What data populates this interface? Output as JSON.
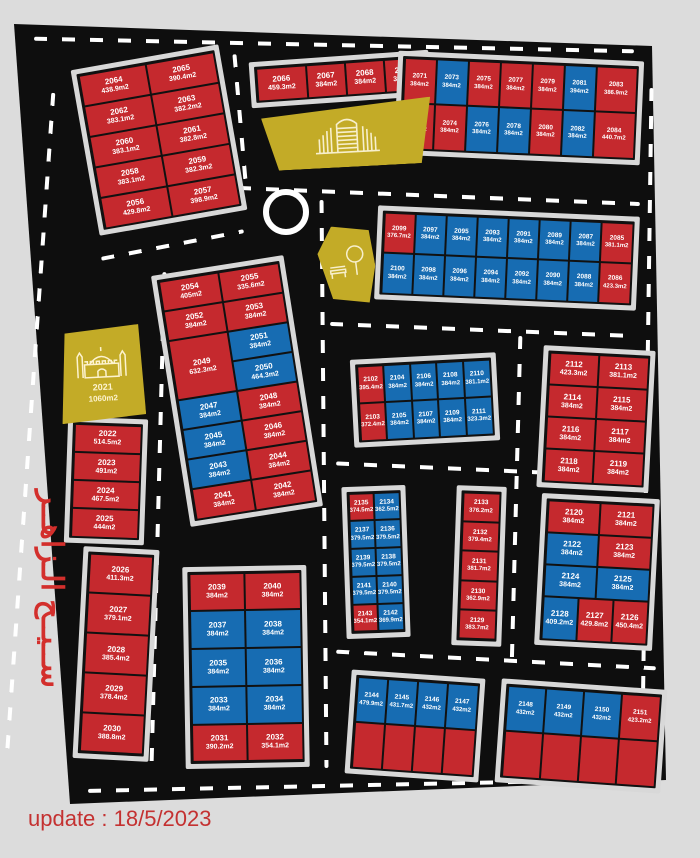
{
  "page": {
    "update_label": "update : 18/5/2023",
    "district_name": "ســيــح الـزاهــر"
  },
  "legend_colors": {
    "plot_red": "#c5292e",
    "plot_blue": "#176cb2",
    "landmark_yellow": "#c3ab27",
    "road_black": "#0e0e0e",
    "sidewalk_gray": "#d8d8d8",
    "page_bg": "#dcdcdc",
    "accent_text_red": "#d32f2c"
  },
  "landmarks": {
    "mosque": {
      "number": "2021",
      "area": "1060m2"
    }
  },
  "blocks": {
    "blockA": {
      "name": "plots 2056-2065",
      "plots": [
        {
          "n": "2064",
          "a": "438.9m2",
          "c": "r"
        },
        {
          "n": "2065",
          "a": "390.4m2",
          "c": "r"
        },
        {
          "n": "2062",
          "a": "383.1m2",
          "c": "r"
        },
        {
          "n": "2063",
          "a": "382.2m2",
          "c": "r"
        },
        {
          "n": "2060",
          "a": "383.1m2",
          "c": "r"
        },
        {
          "n": "2061",
          "a": "382.8m2",
          "c": "r"
        },
        {
          "n": "2058",
          "a": "383.1m2",
          "c": "r"
        },
        {
          "n": "2059",
          "a": "382.3m2",
          "c": "r"
        },
        {
          "n": "2056",
          "a": "429.8m2",
          "c": "r"
        },
        {
          "n": "2057",
          "a": "398.9m2",
          "c": "r"
        }
      ]
    },
    "blockB": {
      "name": "plots 2066-2069",
      "plots": [
        {
          "n": "2066",
          "a": "459.3m2",
          "c": "r"
        },
        {
          "n": "2067",
          "a": "384m2",
          "c": "r"
        },
        {
          "n": "2068",
          "a": "384m2",
          "c": "r"
        },
        {
          "n": "2069",
          "a": "384m2",
          "c": "r"
        }
      ]
    },
    "blockC": {
      "name": "plots 2071-2084",
      "plots": [
        {
          "n": "2071",
          "a": "384m2",
          "c": "r"
        },
        {
          "n": "2073",
          "a": "384m2",
          "c": "b"
        },
        {
          "n": "2075",
          "a": "384m2",
          "c": "r"
        },
        {
          "n": "2077",
          "a": "384m2",
          "c": "r"
        },
        {
          "n": "2079",
          "a": "384m2",
          "c": "r"
        },
        {
          "n": "2081",
          "a": "394m2",
          "c": "b"
        },
        {
          "n": "2083",
          "a": "386.9m2",
          "c": "r"
        },
        {
          "n": "2072",
          "a": "384m2",
          "c": "r"
        },
        {
          "n": "2074",
          "a": "384m2",
          "c": "r"
        },
        {
          "n": "2076",
          "a": "384m2",
          "c": "b"
        },
        {
          "n": "2078",
          "a": "384m2",
          "c": "b"
        },
        {
          "n": "2080",
          "a": "384m2",
          "c": "r"
        },
        {
          "n": "2082",
          "a": "384m2",
          "c": "b"
        },
        {
          "n": "2084",
          "a": "440.7m2",
          "c": "r"
        }
      ]
    },
    "blockD": {
      "name": "plots 2085-2100",
      "plots": [
        {
          "n": "2099",
          "a": "376.7m2",
          "c": "r"
        },
        {
          "n": "2097",
          "a": "384m2",
          "c": "b"
        },
        {
          "n": "2095",
          "a": "384m2",
          "c": "b"
        },
        {
          "n": "2093",
          "a": "384m2",
          "c": "b"
        },
        {
          "n": "2091",
          "a": "384m2",
          "c": "b"
        },
        {
          "n": "2089",
          "a": "384m2",
          "c": "b"
        },
        {
          "n": "2087",
          "a": "384m2",
          "c": "b"
        },
        {
          "n": "2085",
          "a": "381.1m2",
          "c": "r"
        },
        {
          "n": "2100",
          "a": "384m2",
          "c": "b"
        },
        {
          "n": "2098",
          "a": "384m2",
          "c": "b"
        },
        {
          "n": "2096",
          "a": "384m2",
          "c": "b"
        },
        {
          "n": "2094",
          "a": "384m2",
          "c": "b"
        },
        {
          "n": "2092",
          "a": "384m2",
          "c": "b"
        },
        {
          "n": "2090",
          "a": "384m2",
          "c": "b"
        },
        {
          "n": "2088",
          "a": "384m2",
          "c": "b"
        },
        {
          "n": "2086",
          "a": "423.3m2",
          "c": "r"
        }
      ]
    },
    "blockE": {
      "name": "plots 2041-2055",
      "plots": [
        {
          "n": "2054",
          "a": "405m2",
          "c": "r"
        },
        {
          "n": "2055",
          "a": "335.6m2",
          "c": "r"
        },
        {
          "n": "2052",
          "a": "384m2",
          "c": "r"
        },
        {
          "n": "2053",
          "a": "384m2",
          "c": "r"
        },
        {
          "n": "2049",
          "a": "632.3m2",
          "c": "r"
        },
        {
          "n": "2051",
          "a": "384m2",
          "c": "b"
        },
        {
          "n": "2050",
          "a": "464.3m2",
          "c": "b"
        },
        {
          "n": "2047",
          "a": "384m2",
          "c": "b"
        },
        {
          "n": "2048",
          "a": "384m2",
          "c": "r"
        },
        {
          "n": "2045",
          "a": "384m2",
          "c": "b"
        },
        {
          "n": "2046",
          "a": "384m2",
          "c": "r"
        },
        {
          "n": "2043",
          "a": "384m2",
          "c": "b"
        },
        {
          "n": "2044",
          "a": "384m2",
          "c": "r"
        },
        {
          "n": "2041",
          "a": "384m2",
          "c": "r"
        },
        {
          "n": "2042",
          "a": "384m2",
          "c": "r"
        }
      ]
    },
    "blockF": {
      "name": "plots 2022-2025",
      "plots": [
        {
          "n": "2022",
          "a": "514.5m2",
          "c": "r"
        },
        {
          "n": "2023",
          "a": "491m2",
          "c": "r"
        },
        {
          "n": "2024",
          "a": "467.5m2",
          "c": "r"
        },
        {
          "n": "2025",
          "a": "444m2",
          "c": "r"
        }
      ]
    },
    "blockG": {
      "name": "plots 2026-2030",
      "plots": [
        {
          "n": "2026",
          "a": "411.3m2",
          "c": "r"
        },
        {
          "n": "2027",
          "a": "379.1m2",
          "c": "r"
        },
        {
          "n": "2028",
          "a": "385.4m2",
          "c": "r"
        },
        {
          "n": "2029",
          "a": "378.4m2",
          "c": "r"
        },
        {
          "n": "2030",
          "a": "388.8m2",
          "c": "r"
        }
      ]
    },
    "blockH": {
      "name": "plots 2102-2111",
      "plots": [
        {
          "n": "2102",
          "a": "395.4m2",
          "c": "r"
        },
        {
          "n": "2104",
          "a": "384m2",
          "c": "b"
        },
        {
          "n": "2106",
          "a": "384m2",
          "c": "b"
        },
        {
          "n": "2108",
          "a": "384m2",
          "c": "b"
        },
        {
          "n": "2110",
          "a": "381.1m2",
          "c": "b"
        },
        {
          "n": "2103",
          "a": "372.4m2",
          "c": "r"
        },
        {
          "n": "2105",
          "a": "384m2",
          "c": "b"
        },
        {
          "n": "2107",
          "a": "384m2",
          "c": "b"
        },
        {
          "n": "2109",
          "a": "384m2",
          "c": "b"
        },
        {
          "n": "2111",
          "a": "323.3m2",
          "c": "b"
        }
      ]
    },
    "blockI": {
      "name": "plots 2112-2119",
      "plots": [
        {
          "n": "2112",
          "a": "423.3m2",
          "c": "r"
        },
        {
          "n": "2113",
          "a": "381.1m2",
          "c": "r"
        },
        {
          "n": "2114",
          "a": "384m2",
          "c": "r"
        },
        {
          "n": "2115",
          "a": "384m2",
          "c": "r"
        },
        {
          "n": "2116",
          "a": "384m2",
          "c": "r"
        },
        {
          "n": "2117",
          "a": "384m2",
          "c": "r"
        },
        {
          "n": "2118",
          "a": "384m2",
          "c": "r"
        },
        {
          "n": "2119",
          "a": "384m2",
          "c": "r"
        }
      ]
    },
    "blockJ": {
      "name": "plots 2134-2143",
      "plots": [
        {
          "n": "2135",
          "a": "374.5m2",
          "c": "r"
        },
        {
          "n": "2134",
          "a": "362.5m2",
          "c": "b"
        },
        {
          "n": "2137",
          "a": "379.5m2",
          "c": "b"
        },
        {
          "n": "2136",
          "a": "379.5m2",
          "c": "b"
        },
        {
          "n": "2139",
          "a": "379.5m2",
          "c": "b"
        },
        {
          "n": "2138",
          "a": "379.5m2",
          "c": "b"
        },
        {
          "n": "2141",
          "a": "379.5m2",
          "c": "b"
        },
        {
          "n": "2140",
          "a": "379.5m2",
          "c": "b"
        },
        {
          "n": "2143",
          "a": "354.1m2",
          "c": "r"
        },
        {
          "n": "2142",
          "a": "369.9m2",
          "c": "b"
        }
      ]
    },
    "blockK": {
      "name": "plots 2129-2133",
      "plots": [
        {
          "n": "2133",
          "a": "376.2m2",
          "c": "r"
        },
        {
          "n": "2132",
          "a": "379.4m2",
          "c": "r"
        },
        {
          "n": "2131",
          "a": "381.7m2",
          "c": "r"
        },
        {
          "n": "2130",
          "a": "362.9m2",
          "c": "r"
        },
        {
          "n": "2129",
          "a": "383.7m2",
          "c": "r"
        }
      ]
    },
    "blockL": {
      "name": "plots 2120-2128",
      "plots": [
        {
          "n": "2120",
          "a": "384m2",
          "c": "r"
        },
        {
          "n": "2121",
          "a": "384m2",
          "c": "r"
        },
        {
          "n": "2122",
          "a": "384m2",
          "c": "b"
        },
        {
          "n": "2123",
          "a": "384m2",
          "c": "r"
        },
        {
          "n": "2124",
          "a": "384m2",
          "c": "b"
        },
        {
          "n": "2125",
          "a": "384m2",
          "c": "b"
        },
        {
          "n": "2128",
          "a": "409.2m2",
          "c": "b"
        },
        {
          "n": "2127",
          "a": "429.8m2",
          "c": "r"
        },
        {
          "n": "2126",
          "a": "450.4m2",
          "c": "r"
        }
      ]
    },
    "blockM": {
      "name": "plots 2031-2040",
      "plots": [
        {
          "n": "2039",
          "a": "384m2",
          "c": "r"
        },
        {
          "n": "2040",
          "a": "384m2",
          "c": "r"
        },
        {
          "n": "2037",
          "a": "384m2",
          "c": "b"
        },
        {
          "n": "2038",
          "a": "384m2",
          "c": "b"
        },
        {
          "n": "2035",
          "a": "384m2",
          "c": "b"
        },
        {
          "n": "2036",
          "a": "384m2",
          "c": "b"
        },
        {
          "n": "2033",
          "a": "384m2",
          "c": "b"
        },
        {
          "n": "2034",
          "a": "384m2",
          "c": "b"
        },
        {
          "n": "2031",
          "a": "390.2m2",
          "c": "r"
        },
        {
          "n": "2032",
          "a": "354.1m2",
          "c": "r"
        }
      ]
    },
    "blockN": {
      "name": "plots 2144-2147",
      "plots": [
        {
          "n": "2144",
          "a": "479.9m2",
          "c": "b"
        },
        {
          "n": "2145",
          "a": "431.7m2",
          "c": "b"
        },
        {
          "n": "2146",
          "a": "432m2",
          "c": "b"
        },
        {
          "n": "2147",
          "a": "432m2",
          "c": "b"
        },
        {
          "n": "",
          "a": "",
          "c": "r"
        },
        {
          "n": "",
          "a": "",
          "c": "r"
        },
        {
          "n": "",
          "a": "",
          "c": "r"
        },
        {
          "n": "",
          "a": "",
          "c": "r"
        }
      ]
    },
    "blockO": {
      "name": "plots 2148-2151",
      "plots": [
        {
          "n": "2148",
          "a": "432m2",
          "c": "b"
        },
        {
          "n": "2149",
          "a": "432m2",
          "c": "b"
        },
        {
          "n": "2150",
          "a": "432m2",
          "c": "b"
        },
        {
          "n": "2151",
          "a": "423.2m2",
          "c": "r"
        },
        {
          "n": "",
          "a": "",
          "c": "r"
        },
        {
          "n": "",
          "a": "",
          "c": "r"
        },
        {
          "n": "",
          "a": "",
          "c": "r"
        },
        {
          "n": "",
          "a": "",
          "c": "r"
        }
      ]
    }
  }
}
